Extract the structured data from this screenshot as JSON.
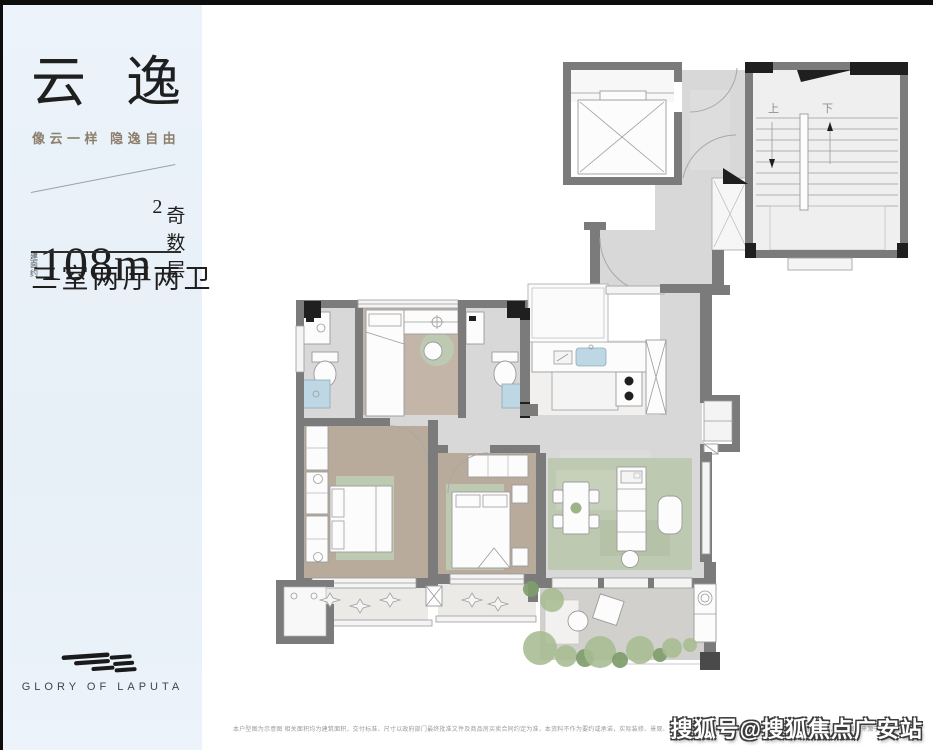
{
  "sidebar": {
    "title": "云逸",
    "subtitle": "像云一样 隐逸自由",
    "area": {
      "prefix_vertical": "建面约",
      "value": "108m",
      "sup": "2",
      "suffix": "奇数层"
    },
    "layout_text": "三室两厅两卫",
    "logo_text": "GLORY OF LAPUTA"
  },
  "floorplan": {
    "stairs_up_label": "上",
    "stairs_down_label": "下"
  },
  "footer": {
    "disclaimer": "本户型图为示意图 相关面积均为建筑面积，交付标准、尺寸以政府部门最终批准文件及商品房买卖合同约定为准，本资料不作为要约或承诺，实际装修、景观、布局等以实际交付为准，开发商保留对规划设计调整的权利，部分图片来源于网络，如有侵权请联系删除，最终解释权归开发商所有",
    "watermark": "搜狐号@搜狐焦点广安站"
  },
  "colors": {
    "sidebar-bg1": "#ecf3fa",
    "sidebar-bg2": "#e7eff7",
    "accent-tan": "#8c7e6b",
    "ink": "#1f1f1f",
    "wall": "#7b7b7b",
    "wall-dark": "#4a4a4a",
    "black-fixture": "#1f1f1f",
    "marble": "#d8d8d8",
    "wood": "#b9ab9c",
    "wood2": "#c3b6a8",
    "rug": "#bdc9b1",
    "balcony": "#eceae6",
    "stone": "#d2d0cc",
    "tree": "#a7bc92",
    "tree-dark": "#7f9c6b",
    "sink-blue": "#bed7e4"
  }
}
